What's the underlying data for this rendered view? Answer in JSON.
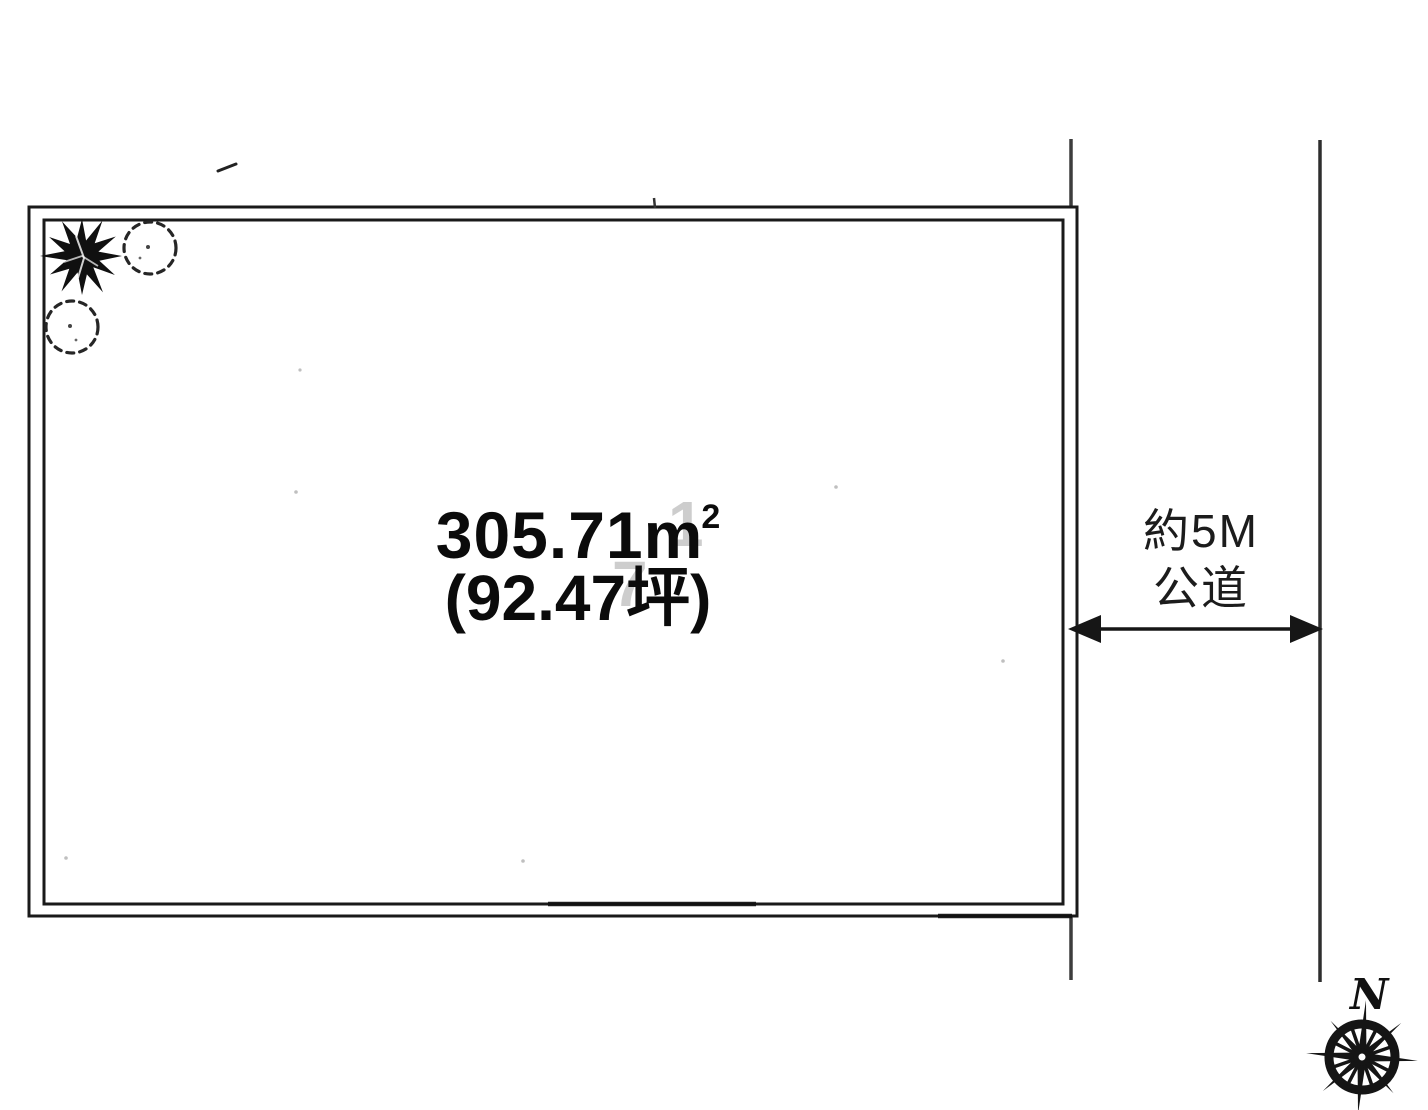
{
  "diagram": {
    "type": "land-parcel-site-plan",
    "parcel": {
      "area_sqm_value": "305.71",
      "area_unit_base": "m",
      "area_unit_exponent": "2",
      "area_tsubo_label": "(92.47坪)"
    },
    "road": {
      "width_label": "約5M",
      "type_label": "公道"
    },
    "compass": {
      "north_label": "N"
    },
    "watermark": {
      "digit_top": "1",
      "digit_bottom": "7"
    },
    "icons": {
      "solid_tree": "solid-shrub-icon",
      "dashed_tree_upper": "dashed-tree-canopy-icon",
      "dashed_tree_lower": "dashed-tree-canopy-icon",
      "compass": "compass-rose-icon",
      "width_arrow": "double-headed-arrow-icon"
    },
    "colors": {
      "ink": "#1a1a1a",
      "road_line": "#3d3d3d",
      "watermark_gray": "#a6a6a6",
      "background": "#ffffff"
    }
  }
}
